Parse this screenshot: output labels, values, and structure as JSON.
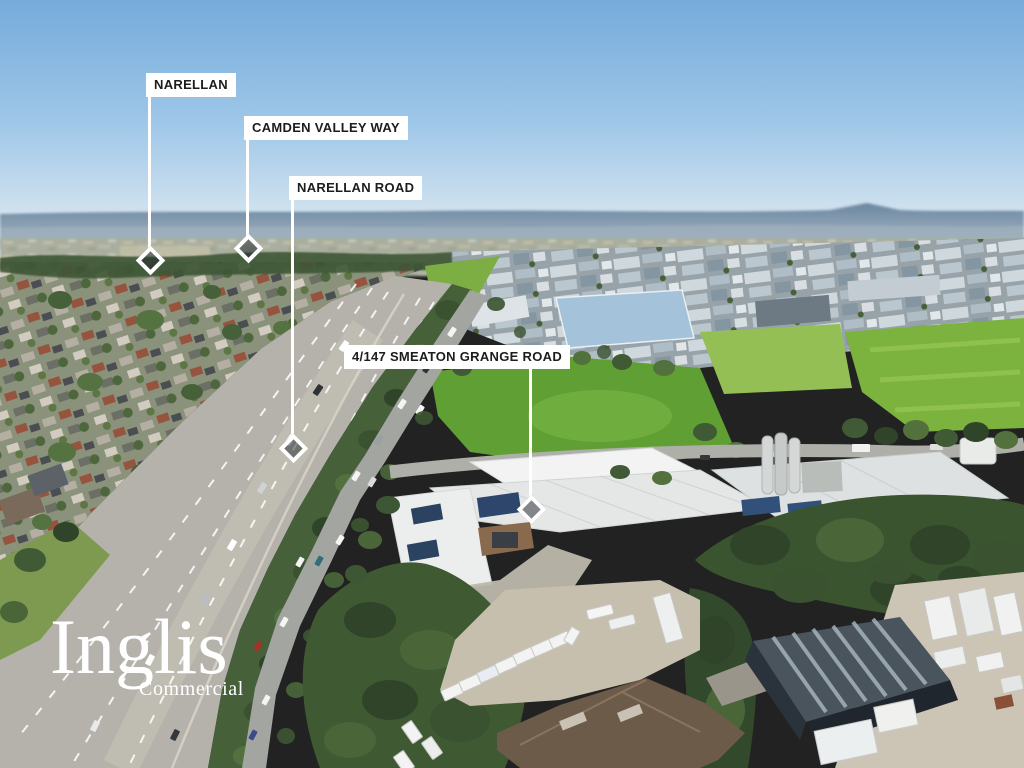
{
  "annotations": {
    "labels": [
      {
        "id": "narellan",
        "text": "NARELLAN"
      },
      {
        "id": "camden-valley-way",
        "text": "CAMDEN VALLEY WAY"
      },
      {
        "id": "narellan-road",
        "text": "NARELLAN ROAD"
      },
      {
        "id": "property-address",
        "text": "4/147 SMEATON GRANGE ROAD"
      }
    ]
  },
  "branding": {
    "name": "Inglis",
    "division": "Commercial"
  },
  "colors": {
    "label_background": "#ffffff",
    "label_text": "#1d1d1b",
    "marker": "#ffffff",
    "logo": "#ffffff",
    "sky_top": "#76abdb"
  }
}
